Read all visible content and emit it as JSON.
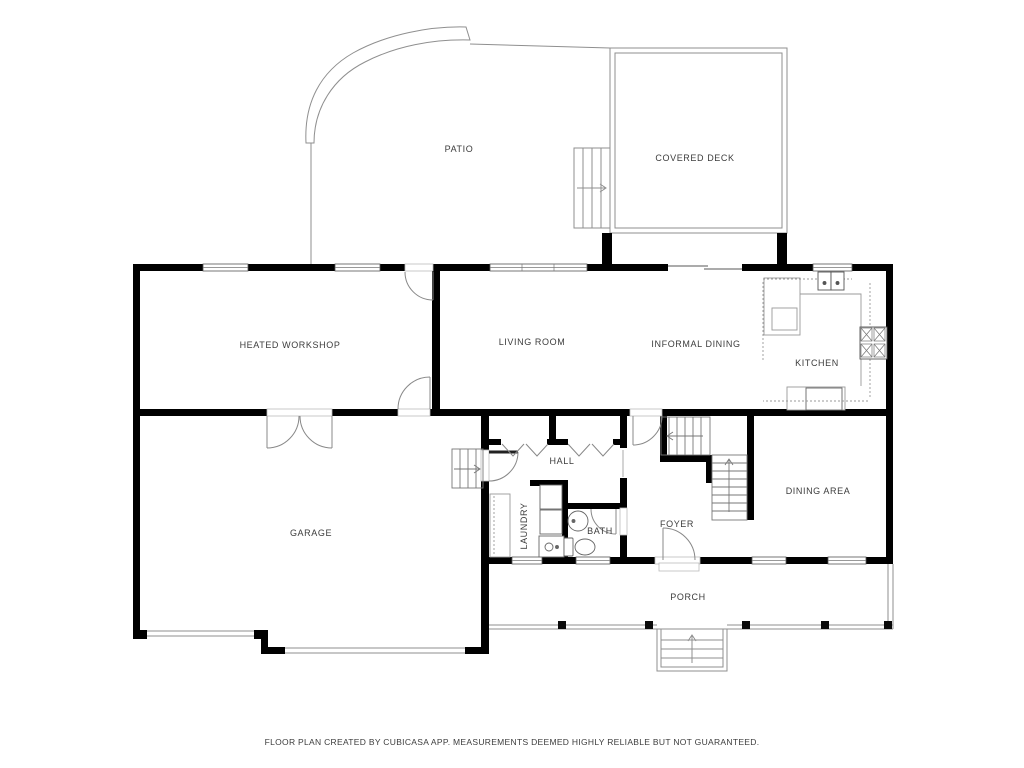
{
  "title": "Floor plan",
  "rooms": {
    "patio": "PATIO",
    "covered_deck": "COVERED DECK",
    "heated_workshop": "HEATED WORKSHOP",
    "living_room": "LIVING ROOM",
    "informal_dining": "INFORMAL DINING",
    "kitchen": "KITCHEN",
    "garage": "GARAGE",
    "hall": "HALL",
    "laundry": "LAUNDRY",
    "bath": "BATH",
    "foyer": "FOYER",
    "dining_area": "DINING AREA",
    "porch": "PORCH"
  },
  "footer": {
    "disclaimer": "FLOOR PLAN CREATED BY CUBICASA APP. MEASUREMENTS DEEMED HIGHLY RELIABLE BUT NOT GUARANTEED."
  },
  "fixtures": [
    "kitchen-sink",
    "stove",
    "kitchen-island",
    "kitchen-counter",
    "washer",
    "dryer",
    "laundry-counter",
    "bath-sink",
    "toilet",
    "basement-stairs",
    "main-stairs",
    "deck-stairs",
    "porch-steps",
    "porch-posts",
    "front-door",
    "garage-doors",
    "french-doors",
    "closet-bifold-doors",
    "sliding-door"
  ],
  "colors": {
    "wall": "#000000",
    "line": "#8f8f8f",
    "background": "#ffffff",
    "label": "#3c3c3c"
  }
}
